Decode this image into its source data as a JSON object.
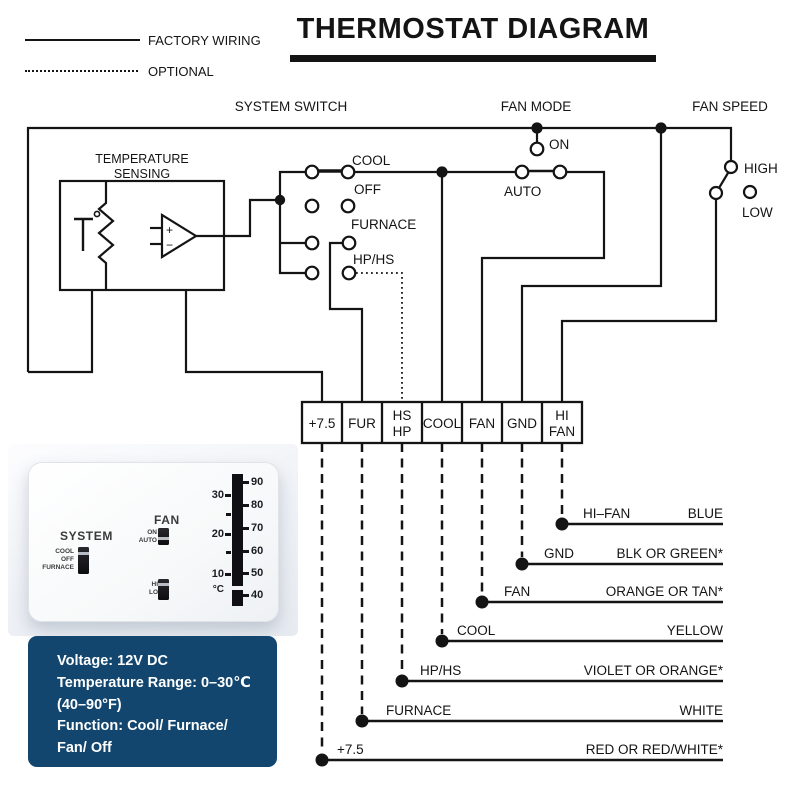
{
  "title": {
    "text": "THERMOSTAT DIAGRAM"
  },
  "legend": {
    "factory_wiring": "FACTORY WIRING",
    "optional": "OPTIONAL"
  },
  "section_labels": {
    "system_switch": "SYSTEM SWITCH",
    "fan_mode": "FAN MODE",
    "fan_speed": "FAN SPEED"
  },
  "temperature_sensing": {
    "line1": "TEMPERATURE",
    "line2": "SENSING",
    "opamp_plus": "+",
    "opamp_minus": "−"
  },
  "system_switch": {
    "cool": "COOL",
    "off": "OFF",
    "furnace": "FURNACE",
    "hp_hs": "HP/HS"
  },
  "fan_mode": {
    "on": "ON",
    "auto": "AUTO"
  },
  "fan_speed": {
    "high": "HIGH",
    "low": "LOW"
  },
  "terminals": [
    {
      "top": "+7.5"
    },
    {
      "top": "FUR"
    },
    {
      "top": "HS",
      "bottom": "HP"
    },
    {
      "top": "COOL"
    },
    {
      "top": "FAN"
    },
    {
      "top": "GND"
    },
    {
      "top": "HI",
      "bottom": "FAN"
    }
  ],
  "wires": [
    {
      "terminal": "HI–FAN",
      "color": "BLUE"
    },
    {
      "terminal": "GND",
      "color": "BLK OR GREEN*"
    },
    {
      "terminal": "FAN",
      "color": "ORANGE OR TAN*"
    },
    {
      "terminal": "COOL",
      "color": "YELLOW"
    },
    {
      "terminal": "HP/HS",
      "color": "VIOLET OR ORANGE*"
    },
    {
      "terminal": "FURNACE",
      "color": "WHITE"
    },
    {
      "terminal": "+7.5",
      "color": "RED OR RED/WHITE*"
    }
  ],
  "thermostat": {
    "system_label": "SYSTEM",
    "system_cool": "COOL",
    "system_off": "OFF",
    "system_furnace": "FURNACE",
    "fan_label": "FAN",
    "fan_on": "ON",
    "fan_auto": "AUTO",
    "speed_hi": "HI",
    "speed_lo": "LO",
    "scale_c": [
      "30",
      "20",
      "10"
    ],
    "scale_f": [
      "90",
      "80",
      "70",
      "60",
      "50",
      "40"
    ],
    "unit_c": "°C"
  },
  "info_box": {
    "bg_color": "#12466F",
    "lines": [
      "Voltage: 12V DC",
      "Temperature Range: 0–30℃",
      "(40–90°F)",
      "Function: Cool/ Furnace/",
      "Fan/ Off"
    ]
  }
}
